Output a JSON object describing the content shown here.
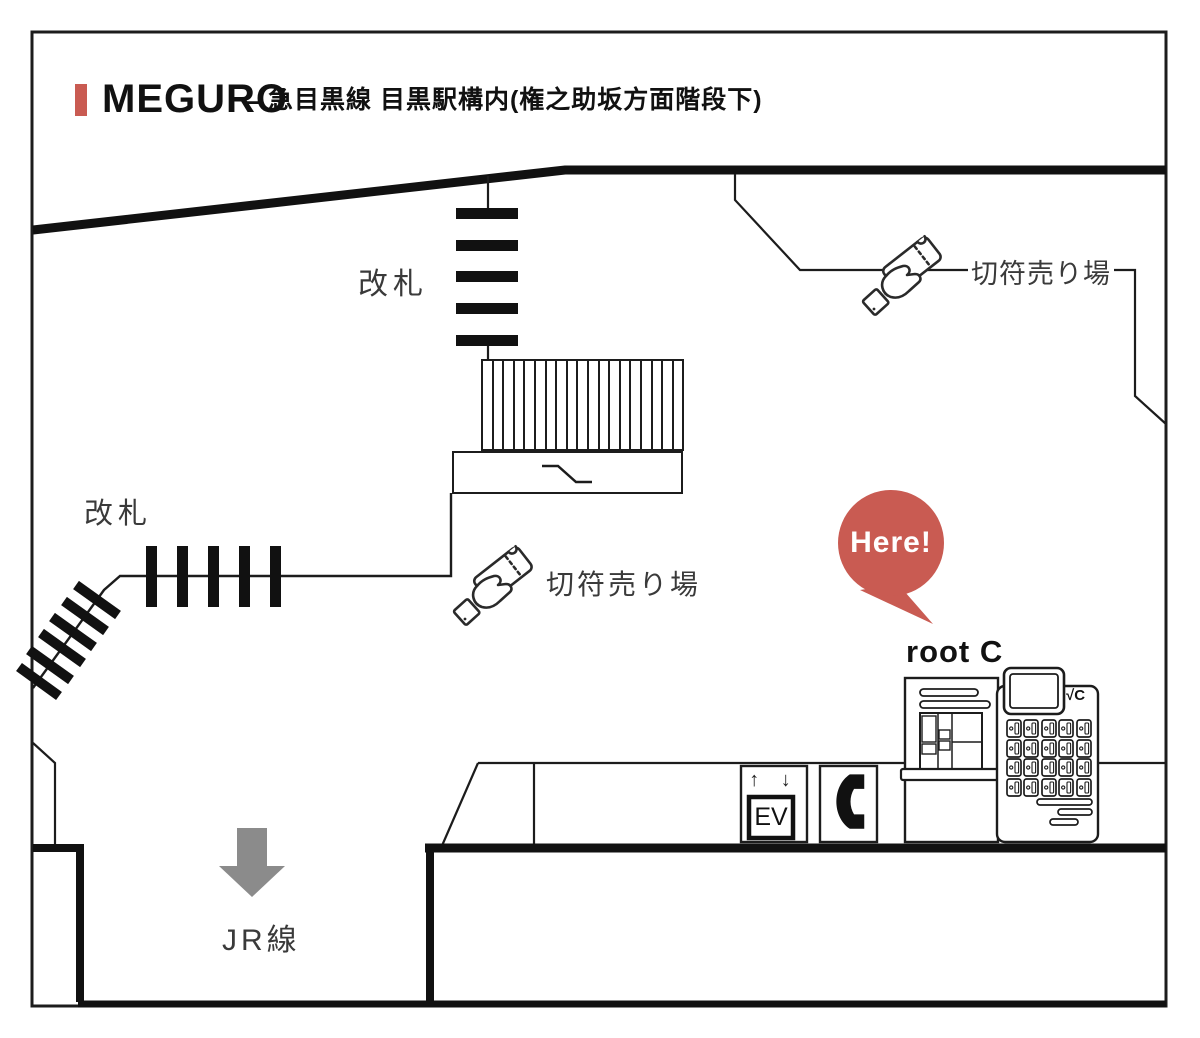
{
  "title": {
    "station": "MEGURO",
    "separator": "–",
    "line_info": "急目黒線 目黒駅構内(権之助坂方面階段下)"
  },
  "labels": {
    "gate_top": "改札",
    "gate_left": "改札",
    "ticket_office_top": "切符売り場",
    "ticket_office_center": "切符売り場",
    "here_badge": "Here!",
    "rootc": "root C",
    "rootc_logo": "√C",
    "jr_line": "JR線",
    "elevator_arrows": "↑ ↓",
    "elevator": "EV"
  },
  "colors": {
    "accent_red": "#C95B52",
    "arrow_gray": "#8B8B8B",
    "line_black": "#1C1C1C",
    "label_gray": "#3A3A3A"
  }
}
